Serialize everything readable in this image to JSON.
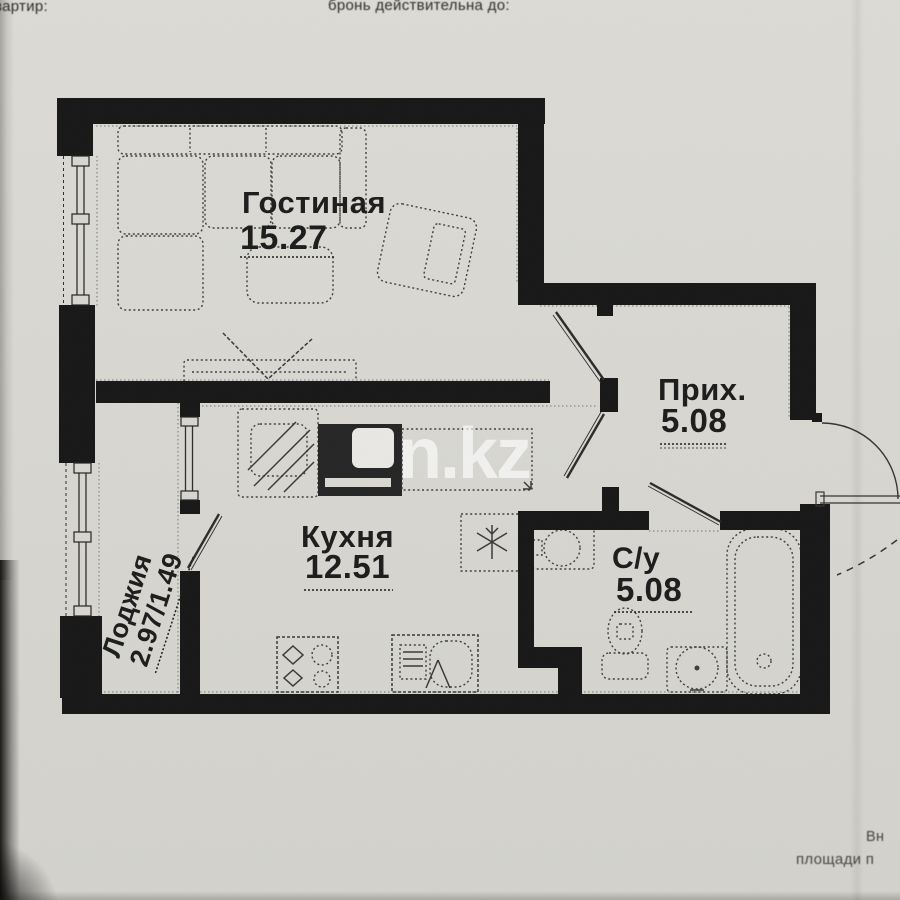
{
  "document": {
    "header_left": "вартир:",
    "header_right": "бронь действительна до:",
    "footer_line1": "Вн",
    "footer_line2": "площади п"
  },
  "watermark": {
    "text": "n.kz"
  },
  "floor_plan": {
    "type": "apartment-floor-plan",
    "rooms": [
      {
        "key": "living",
        "name": "Гостиная",
        "area": "15.27"
      },
      {
        "key": "kitchen",
        "name": "Кухня",
        "area": "12.51"
      },
      {
        "key": "hallway",
        "name": "Прих.",
        "area": "5.08"
      },
      {
        "key": "bathroom",
        "name": "С/у",
        "area": "5.08"
      },
      {
        "key": "loggia",
        "name": "Лоджия",
        "area": "2.97/1.49"
      }
    ],
    "colors": {
      "paper": "#d8d7d2",
      "wall": "#161616",
      "line": "#3e3e3e",
      "watermark_white": "#ffffff"
    }
  }
}
